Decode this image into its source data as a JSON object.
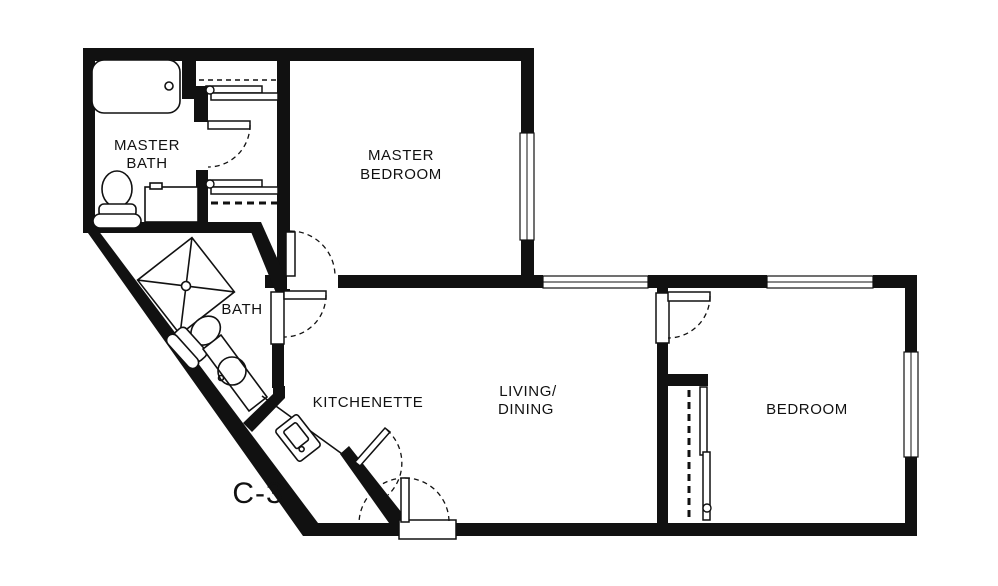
{
  "floor_plan": {
    "unit_label": "C-3",
    "colors": {
      "background": "#ffffff",
      "walls": "#111111",
      "lines": "#111111"
    },
    "rooms": {
      "master_bath": {
        "label_lines": [
          "MASTER",
          "BATH"
        ]
      },
      "master_bedroom": {
        "label_lines": [
          "MASTER",
          "BEDROOM"
        ]
      },
      "bath": {
        "label_lines": [
          "BATH"
        ]
      },
      "kitchenette": {
        "label_lines": [
          "KITCHENETTE"
        ]
      },
      "living_dining": {
        "label_lines": [
          "LIVING/",
          "DINING"
        ]
      },
      "bedroom": {
        "label_lines": [
          "BEDROOM"
        ]
      }
    },
    "symbols": [
      "bathtub-icon",
      "toilet-icon",
      "vanity-sink-icon",
      "corner-shower-icon",
      "round-sink-icon",
      "kitchen-sink-icon",
      "door-swing-icon",
      "window-icon",
      "closet-rod-icon",
      "bypass-door-icon"
    ]
  }
}
